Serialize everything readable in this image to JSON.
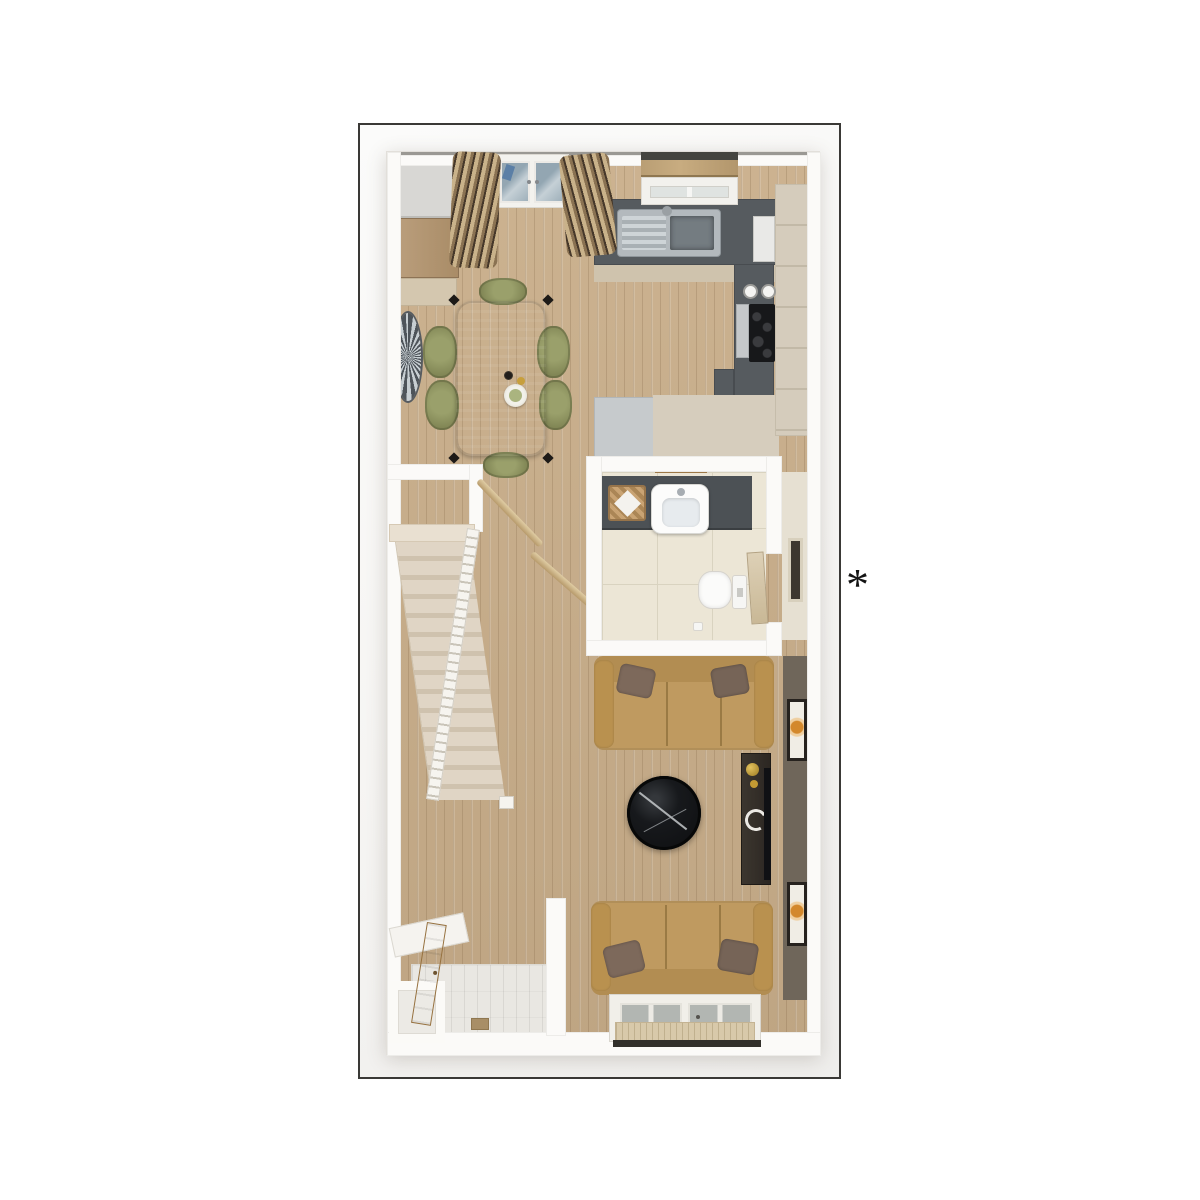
{
  "annotation": {
    "symbol": "*"
  },
  "floorplan": {
    "view": "3d-top-down-floor-plan",
    "rooms": [
      {
        "name": "kitchen-dining-room",
        "features": [
          "french-doors",
          "curtains",
          "kitchen-window-with-blind",
          "l-shaped-dark-counter",
          "sink-with-drainer",
          "hob",
          "tall-cabinet",
          "fridge-block",
          "dining-table",
          "six-olive-chairs",
          "sunburst-mirror"
        ]
      },
      {
        "name": "wc-bathroom",
        "features": [
          "dark-vanity-counter",
          "white-basin",
          "wicker-basket-with-towel",
          "towel-shelf",
          "toilet",
          "open-door",
          "cream-tiled-floor"
        ]
      },
      {
        "name": "living-room",
        "features": [
          "three-seat-sofa-north",
          "three-seat-sofa-south",
          "round-marble-coffee-table",
          "tv-console",
          "two-wall-art-frames",
          "french-window",
          "door-mat",
          "dark-feature-wall"
        ]
      },
      {
        "name": "entry-hall",
        "features": [
          "oak-front-door",
          "wall-shelf",
          "storage-closet",
          "tiled-floor",
          "drain-mat"
        ]
      },
      {
        "name": "staircase",
        "features": [
          "carpeted-steps",
          "white-banister",
          "two-handrails",
          "landing-step"
        ]
      }
    ]
  },
  "palette": {
    "page_background": "#ffffff",
    "frame_border": "#3a3936",
    "wall": "#fbfaf8",
    "wood_floor": "#c9ae8a",
    "kitchen_counter": "#565b5f",
    "kitchen_cabinet": "#d5ccbc",
    "dining_table": "#5b6472",
    "chair_olive": "#8a8f5f",
    "stair_carpet": "#d9cec0",
    "bathroom_tile": "#ece6d6",
    "vanity": "#4c5155",
    "sofa_tan": "#c09a5f",
    "pillow_brown": "#7d695b",
    "coffee_table_marble": "#17191c",
    "tv_console": "#36302a",
    "feature_wall": "#6f665a",
    "entry_tile": "#e9e7e2",
    "door_oak": "#c39c64",
    "accent_gold": "#c9a53a",
    "art_orange": "#d3882c"
  }
}
